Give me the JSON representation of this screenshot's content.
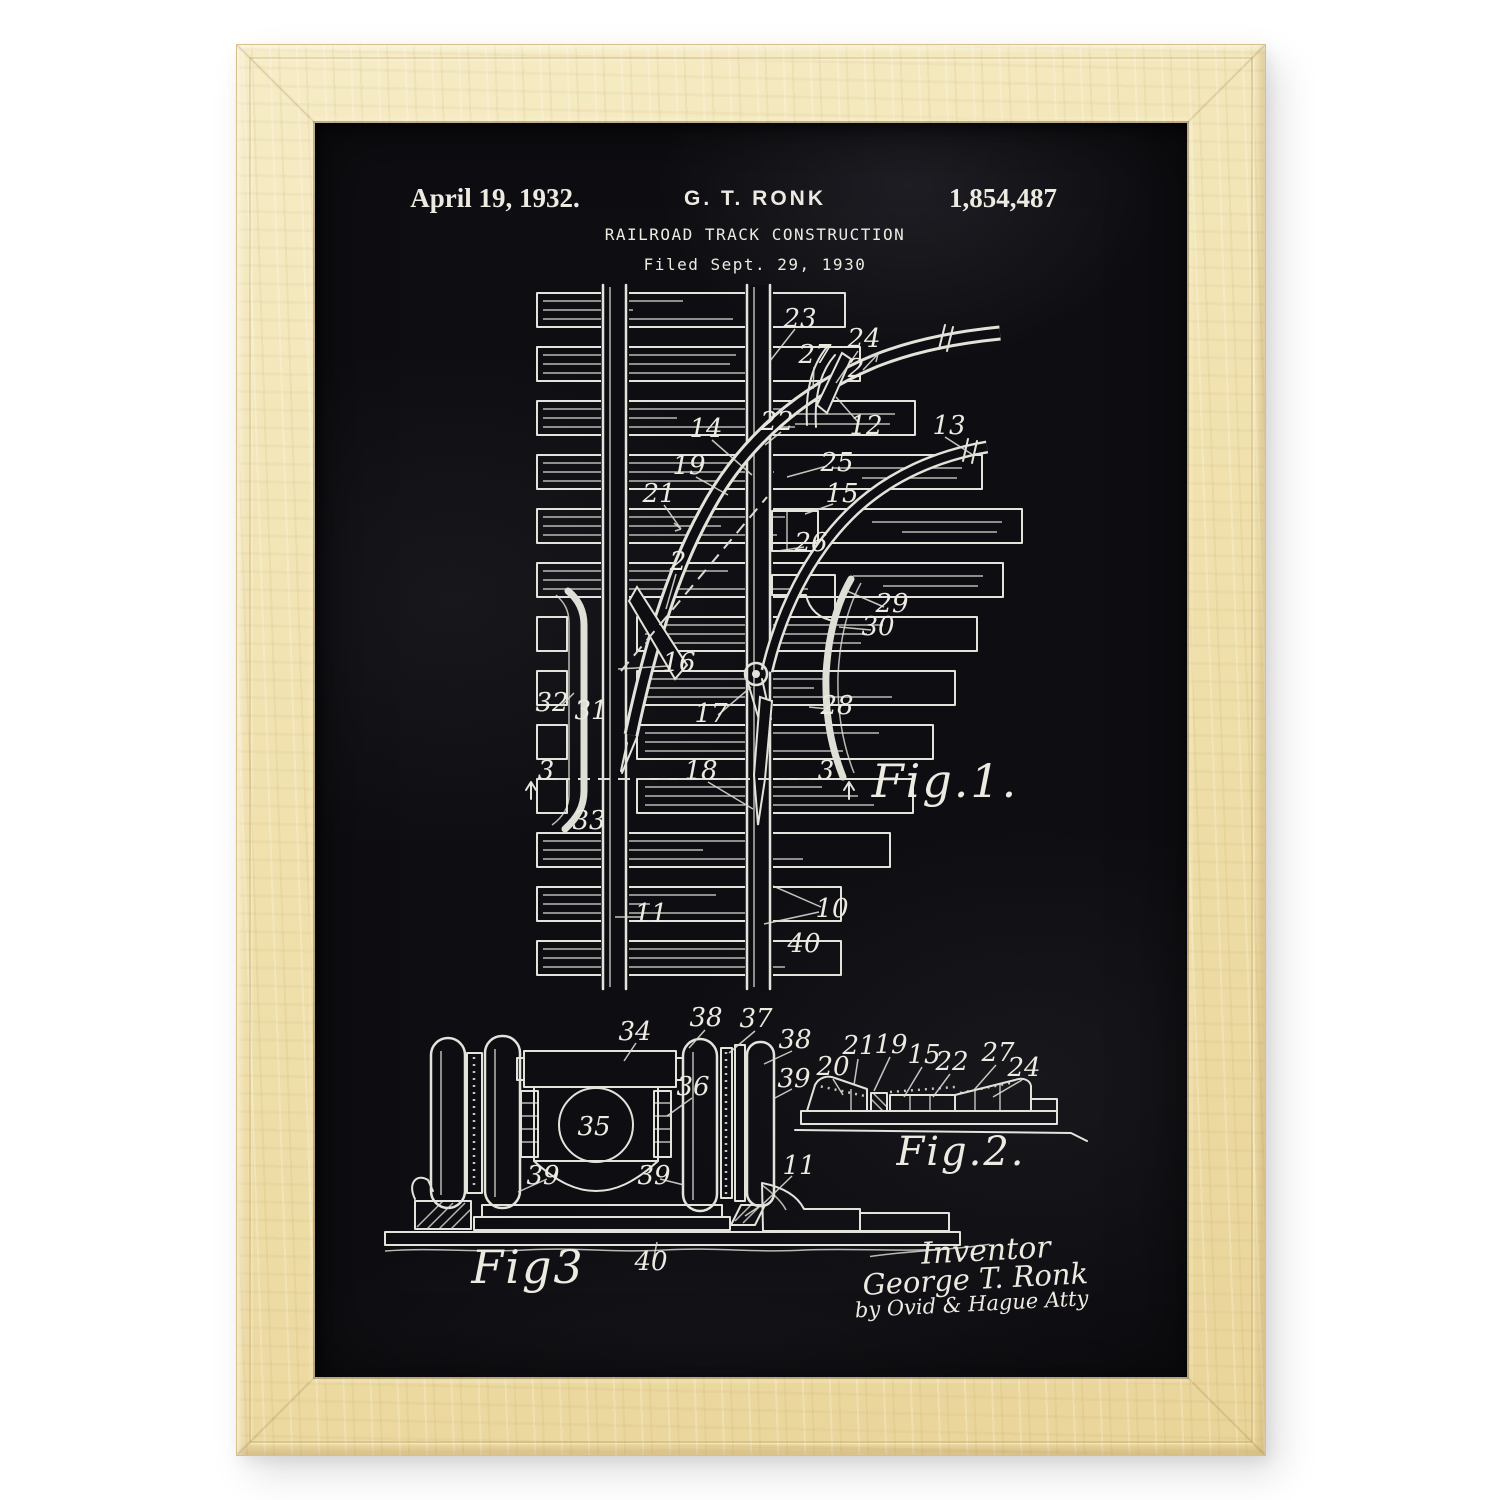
{
  "poster": {
    "header": {
      "date": "April 19, 1932.",
      "inventor": "G. T. RONK",
      "patent_number": "1,854,487",
      "title": "RAILROAD TRACK CONSTRUCTION",
      "filed": "Filed Sept. 29, 1930"
    },
    "figures": {
      "fig1": {
        "caption": "Fig.1.",
        "labels": [
          {
            "t": "23",
            "x": 485,
            "y": 204
          },
          {
            "t": "27",
            "x": 500,
            "y": 240
          },
          {
            "t": "24",
            "x": 549,
            "y": 224
          },
          {
            "t": "2",
            "x": 541,
            "y": 254
          },
          {
            "t": "22",
            "x": 462,
            "y": 307
          },
          {
            "t": "12",
            "x": 551,
            "y": 311
          },
          {
            "t": "13",
            "x": 634,
            "y": 311
          },
          {
            "t": "14",
            "x": 391,
            "y": 314
          },
          {
            "t": "19",
            "x": 374,
            "y": 351
          },
          {
            "t": "25",
            "x": 522,
            "y": 348
          },
          {
            "t": "15",
            "x": 527,
            "y": 379
          },
          {
            "t": "21",
            "x": 344,
            "y": 379
          },
          {
            "t": "26",
            "x": 496,
            "y": 428
          },
          {
            "t": "2",
            "x": 363,
            "y": 447
          },
          {
            "t": "29",
            "x": 577,
            "y": 489
          },
          {
            "t": "30",
            "x": 563,
            "y": 512
          },
          {
            "t": "16",
            "x": 364,
            "y": 548
          },
          {
            "t": "17",
            "x": 396,
            "y": 599
          },
          {
            "t": "28",
            "x": 522,
            "y": 591
          },
          {
            "t": "32",
            "x": 237,
            "y": 588
          },
          {
            "t": "31",
            "x": 276,
            "y": 596
          },
          {
            "t": "3",
            "x": 231,
            "y": 656
          },
          {
            "t": "18",
            "x": 386,
            "y": 656
          },
          {
            "t": "3",
            "x": 511,
            "y": 656
          },
          {
            "t": "33",
            "x": 274,
            "y": 706
          },
          {
            "t": "11",
            "x": 336,
            "y": 799
          },
          {
            "t": "10",
            "x": 517,
            "y": 794
          },
          {
            "t": "40",
            "x": 489,
            "y": 829
          }
        ]
      },
      "fig2": {
        "caption": "Fig.2.",
        "labels": [
          {
            "t": "20",
            "x": 518,
            "y": 952
          },
          {
            "t": "21",
            "x": 544,
            "y": 931
          },
          {
            "t": "19",
            "x": 576,
            "y": 930
          },
          {
            "t": "15",
            "x": 609,
            "y": 940
          },
          {
            "t": "22",
            "x": 637,
            "y": 947
          },
          {
            "t": "27",
            "x": 683,
            "y": 938
          },
          {
            "t": "24",
            "x": 709,
            "y": 953
          }
        ]
      },
      "fig3": {
        "caption": "Fig3",
        "labels": [
          {
            "t": "34",
            "x": 320,
            "y": 917
          },
          {
            "t": "38",
            "x": 391,
            "y": 903
          },
          {
            "t": "37",
            "x": 441,
            "y": 904
          },
          {
            "t": "38",
            "x": 480,
            "y": 925
          },
          {
            "t": "39",
            "x": 479,
            "y": 964
          },
          {
            "t": "36",
            "x": 378,
            "y": 972
          },
          {
            "t": "35",
            "x": 279,
            "y": 1012
          },
          {
            "t": "39",
            "x": 228,
            "y": 1061
          },
          {
            "t": "39",
            "x": 339,
            "y": 1061
          },
          {
            "t": "11",
            "x": 484,
            "y": 1051
          },
          {
            "t": "40",
            "x": 336,
            "y": 1147
          }
        ]
      }
    },
    "signature": {
      "title": "Inventor",
      "name": "George T. Ronk",
      "attorney": "by Ovid & Hague Atty"
    },
    "colors": {
      "ink": "#e3e3db",
      "paper": "#0e0e12",
      "wood": "#efdfab"
    }
  }
}
